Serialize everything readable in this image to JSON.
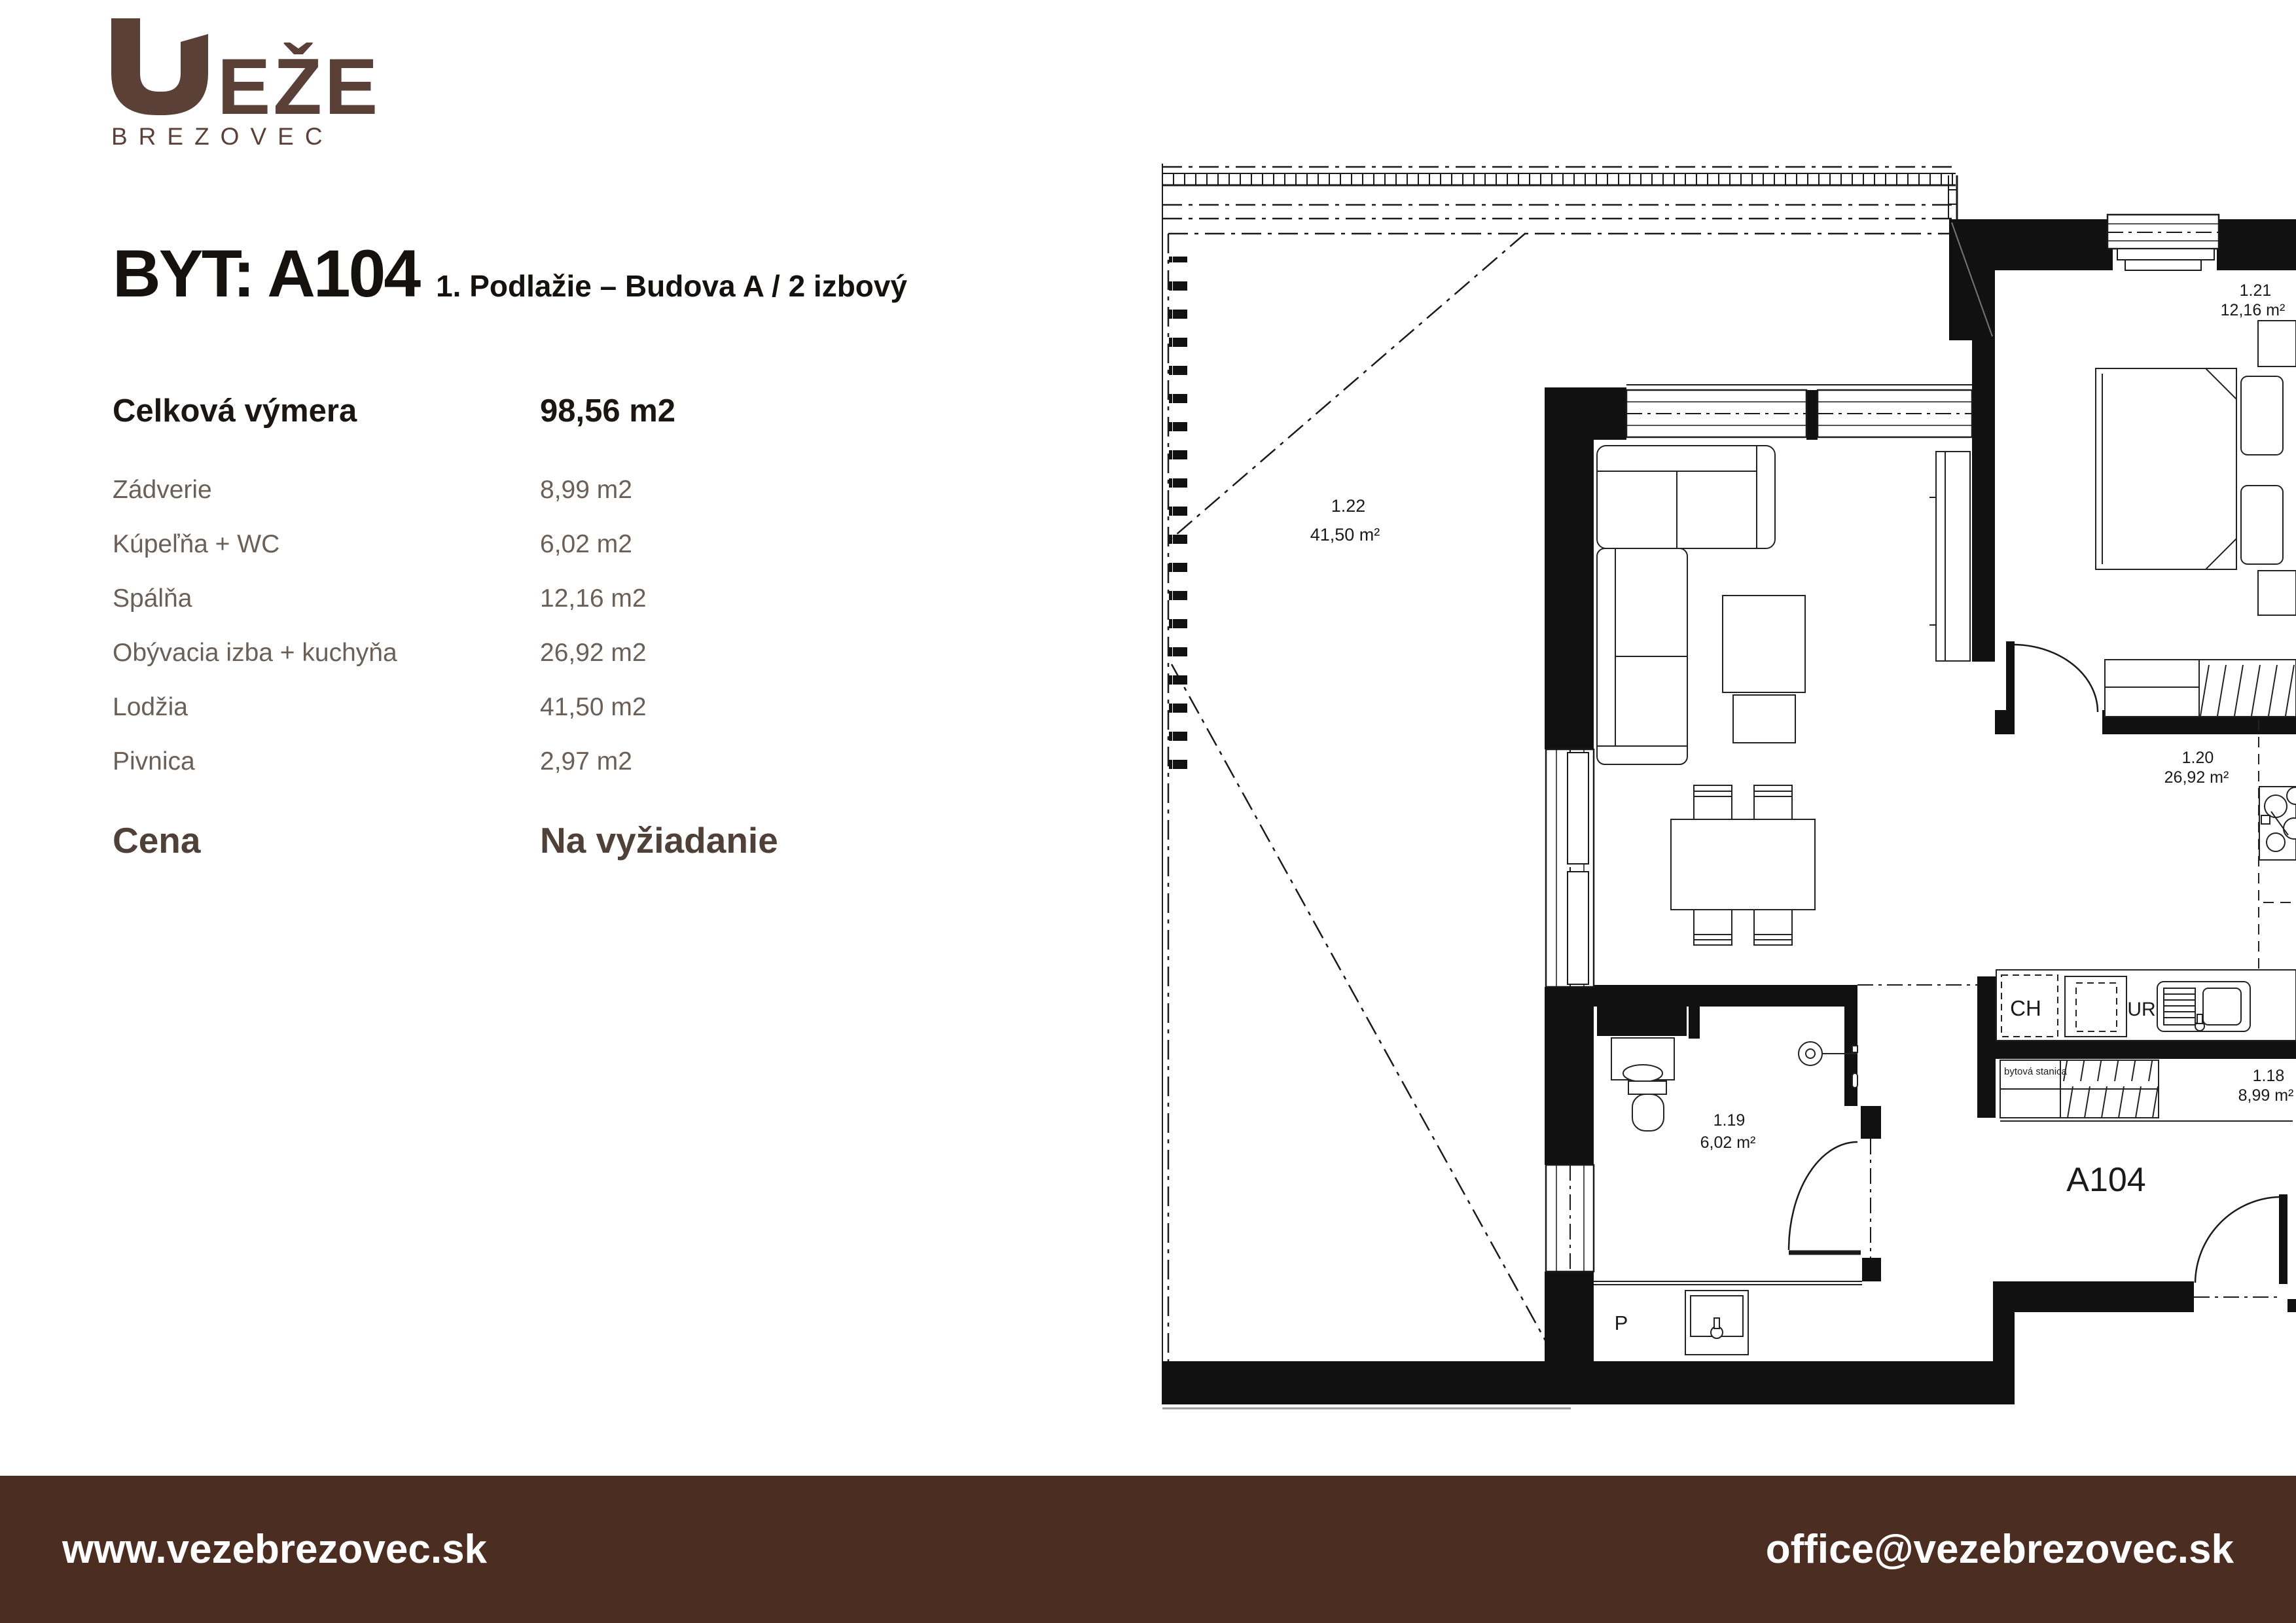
{
  "brand": {
    "name": "VEŽE",
    "wordmark_letters": "EŽE",
    "subname": "BREZOVEC"
  },
  "header": {
    "title": "BYT: A104",
    "subtitle": "1. Podlažie – Budova A / 2 izbový"
  },
  "area_table": {
    "total_label": "Celková výmera",
    "total_value": "98,56 m2",
    "rows": [
      {
        "label": "Zádverie",
        "value": "8,99 m2"
      },
      {
        "label": "Kúpeľňa + WC",
        "value": "6,02 m2"
      },
      {
        "label": "Spálňa",
        "value": "12,16 m2"
      },
      {
        "label": "Obývacia izba + kuchyňa",
        "value": "26,92 m2"
      },
      {
        "label": "Lodžia",
        "value": "41,50 m2"
      },
      {
        "label": "Pivnica",
        "value": "2,97 m2"
      }
    ],
    "price_label": "Cena",
    "price_value": "Na vyžiadanie"
  },
  "footer": {
    "website": "www.vezebrezovec.sk",
    "email": "office@vezebrezovec.sk"
  },
  "plan": {
    "apartment_label": "A104",
    "rooms": [
      {
        "code": "1.22",
        "area": "41,50 m²"
      },
      {
        "code": "1.21",
        "area": "12,16 m²"
      },
      {
        "code": "1.20",
        "area": "26,92 m²"
      },
      {
        "code": "1.19",
        "area": "6,02 m²"
      },
      {
        "code": "1.18",
        "area": "8,99 m²"
      }
    ],
    "labels": {
      "ch": "CH",
      "ur": "UR",
      "p": "P",
      "utility": "bytová stanica"
    }
  },
  "colors": {
    "brand_brown": "#5a4036",
    "footer_brown": "#4c2d21",
    "text_dark": "#15110e",
    "text_muted": "#6b6057",
    "price_brown": "#4f4138"
  }
}
